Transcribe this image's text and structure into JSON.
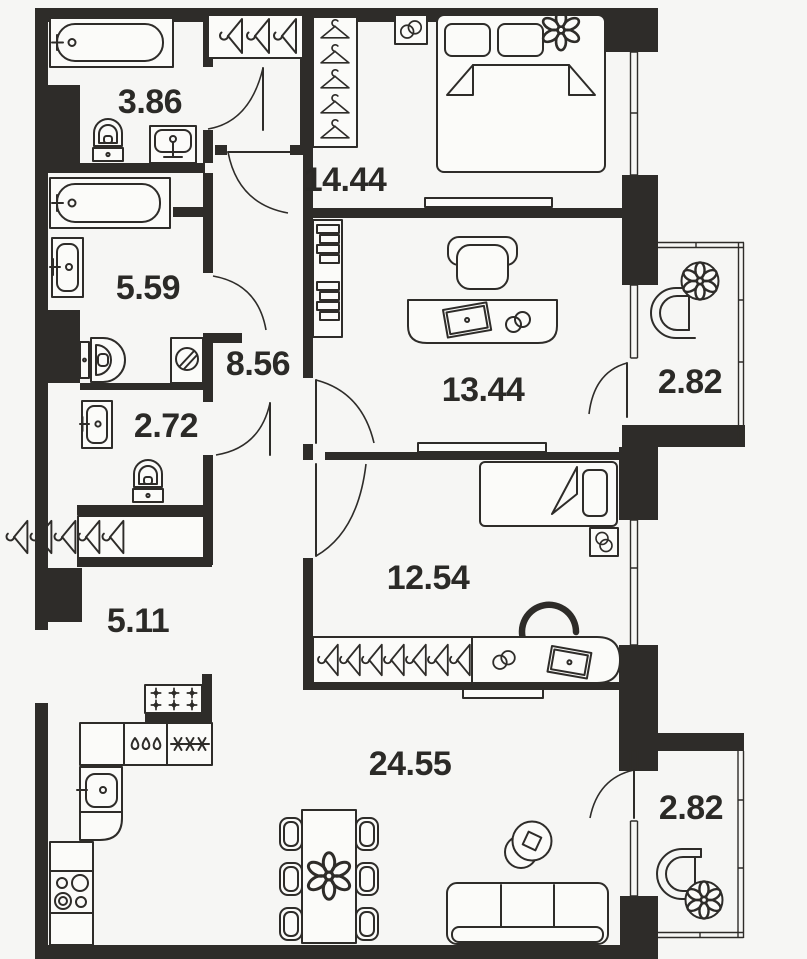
{
  "plan_title": "apartment-floor-plan",
  "colors": {
    "bg": "#f6f6f4",
    "wall": "#2e2c29",
    "line": "#2e2c29",
    "label": "#2b2a27",
    "fill": "#fbfbf9"
  },
  "rooms": [
    {
      "name": "bathroom-small",
      "area": "3.86"
    },
    {
      "name": "bedroom",
      "area": "14.44"
    },
    {
      "name": "bathroom",
      "area": "5.59"
    },
    {
      "name": "hallway",
      "area": "8.56"
    },
    {
      "name": "wc",
      "area": "2.72"
    },
    {
      "name": "office",
      "area": "13.44"
    },
    {
      "name": "balcony-top",
      "area": "2.82"
    },
    {
      "name": "corridor",
      "area": "5.11"
    },
    {
      "name": "kids-room",
      "area": "12.54"
    },
    {
      "name": "kitchen-living-room",
      "area": "24.55"
    },
    {
      "name": "balcony-bottom",
      "area": "2.82"
    }
  ]
}
